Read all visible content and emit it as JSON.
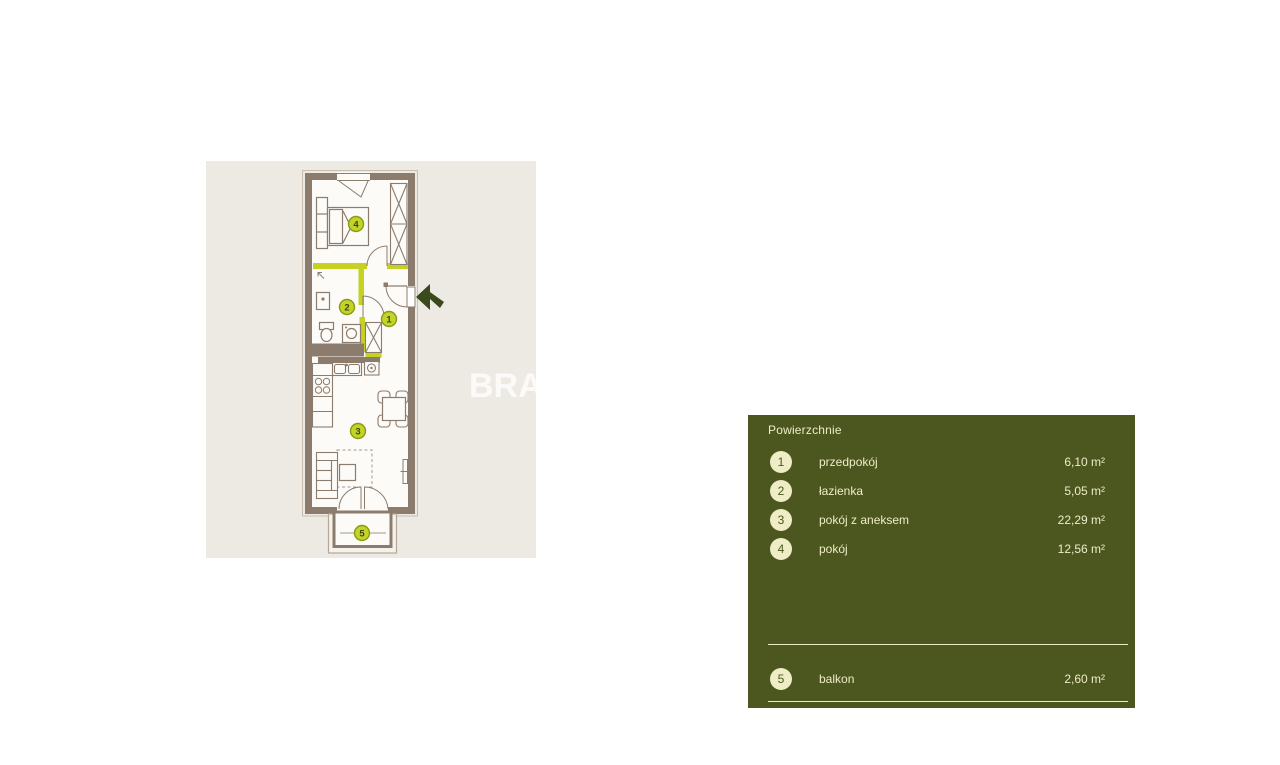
{
  "floor_plan": {
    "watermark": "BRA",
    "markers": [
      "1",
      "2",
      "3",
      "4",
      "5"
    ],
    "colors": {
      "background": "#edeae3",
      "room_fill": "#fcfbf8",
      "wall": "#8b7c6e",
      "accent": "#c5d221",
      "marker_fill": "#c3d32a",
      "marker_border": "#8a9a14",
      "entrance_arrow": "#3b4a1c"
    }
  },
  "legend": {
    "title": "Powierzchnie",
    "colors": {
      "background": "#4c571f",
      "text": "#eeecc8"
    },
    "rows": [
      {
        "number": "1",
        "label": "przedpokój",
        "area": "6,10 m²"
      },
      {
        "number": "2",
        "label": "łazienka",
        "area": "5,05 m²"
      },
      {
        "number": "3",
        "label": "pokój z aneksem",
        "area": "22,29 m²"
      },
      {
        "number": "4",
        "label": "pokój",
        "area": "12,56 m²"
      }
    ],
    "footer_row": {
      "number": "5",
      "label": "balkon",
      "area": "2,60 m²"
    }
  }
}
